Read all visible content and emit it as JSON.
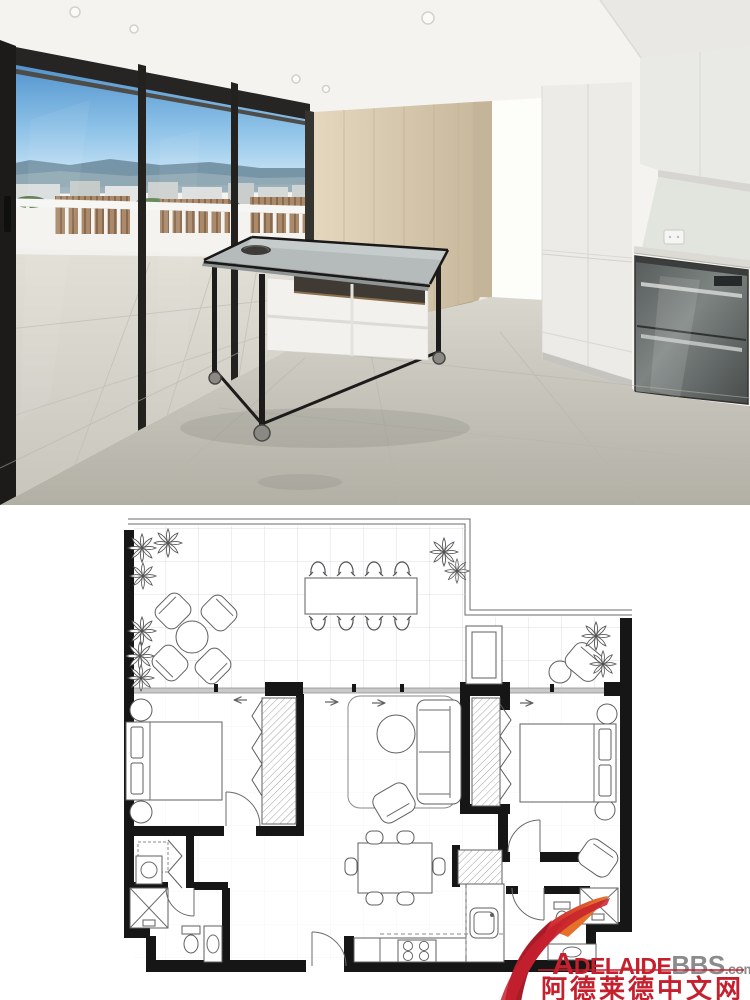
{
  "watermark": {
    "brand_initial": "A",
    "brand_rest": "DELAIDE",
    "brand_suffix": "BBS",
    "brand_tld": ".com",
    "tagline_cn": "阿德莱德中文网",
    "colors": {
      "red": "#c5202e",
      "dark_red": "#a81c2a",
      "orange": "#e4702a",
      "gray": "#8a8b8d"
    }
  },
  "photo": {
    "palette": {
      "sky_top": "#3b82c4",
      "sky_horizon": "#d6ecf8",
      "mountains": "#7291a3",
      "wood_wall": "#d9cbb0",
      "cabinets": "#edecea",
      "appliance_steel": "#5a5f5e",
      "floor": "#c9c7bd",
      "frame_black": "#23221f",
      "balustrade": "#f3f3f0"
    }
  },
  "floorplan": {
    "palette": {
      "wall": "#161616",
      "line": "#5f5f5f",
      "grid": "#d7dce1",
      "paper": "#ffffff"
    }
  }
}
